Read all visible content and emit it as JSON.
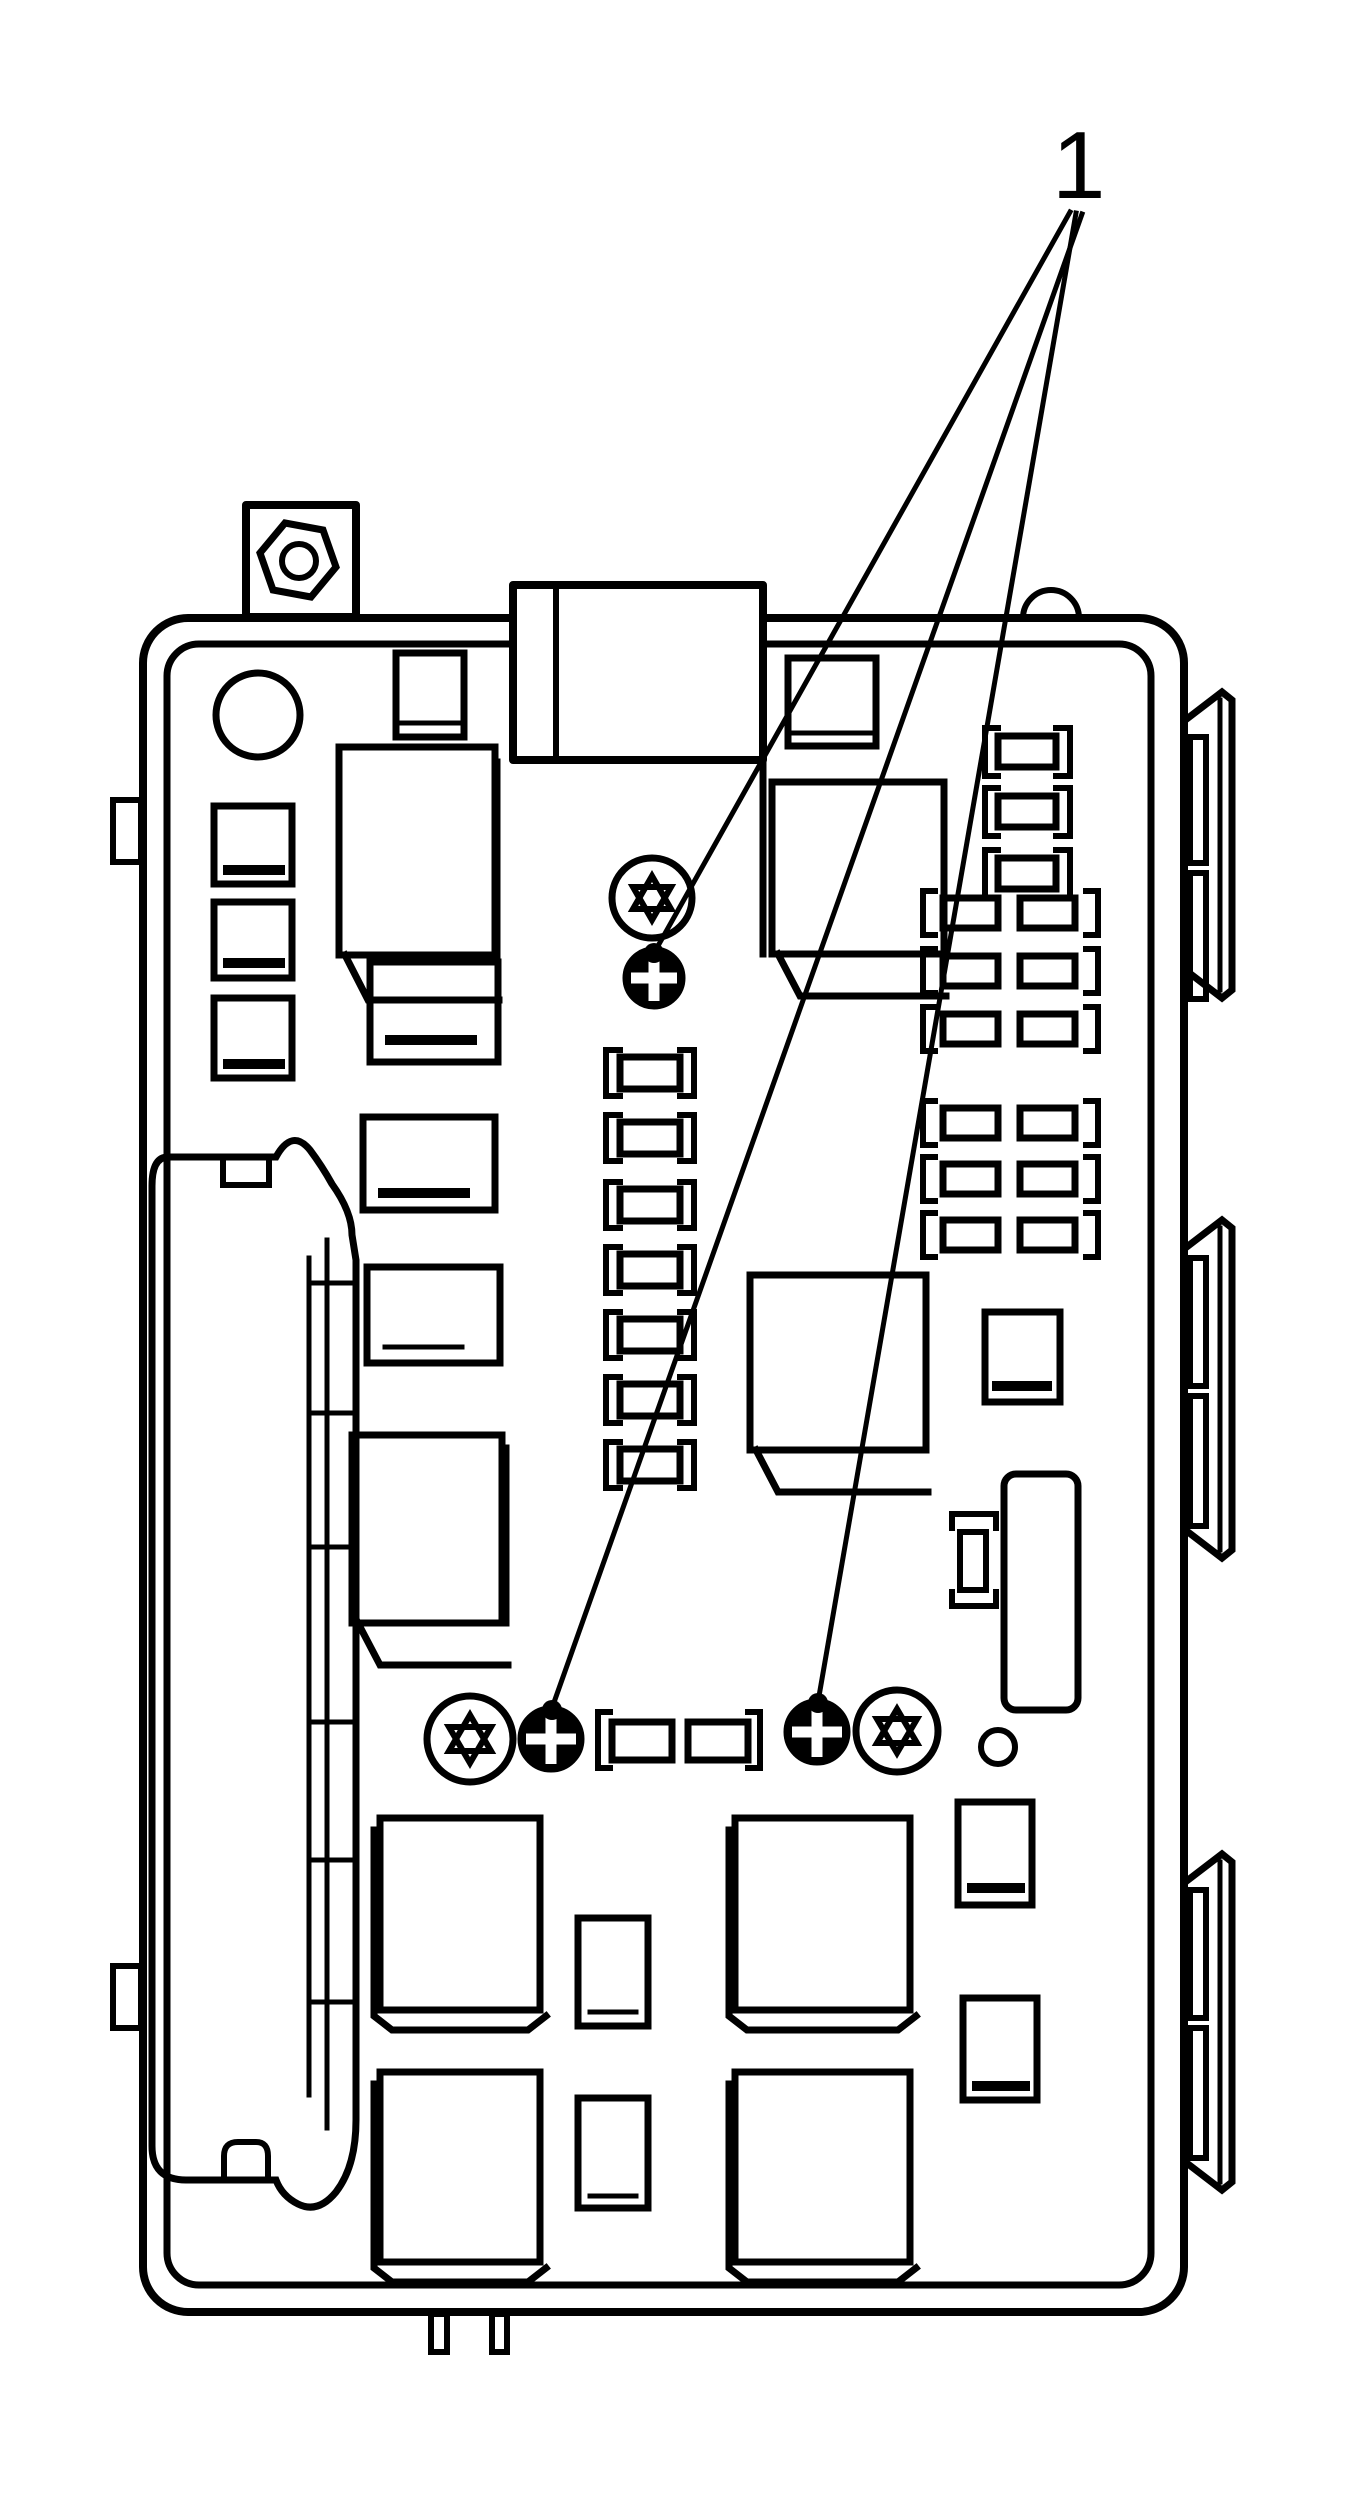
{
  "figure": {
    "kind": "technical-line-diagram",
    "subject": "electrical fuse-relay block with retaining screws"
  },
  "palette": {
    "ink": "#000000",
    "paper": "#ffffff"
  },
  "callout": {
    "label": "1",
    "leader_line_count": 3,
    "targets": [
      "top-phillips-screw",
      "left-phillips-screw",
      "right-phillips-screw"
    ]
  },
  "icons": {
    "torx_screw": "circle-with-six-point-star",
    "phillips_screw": "circle-with-cross",
    "hex_nut": "hexagon-with-circle",
    "fuse": "bracketed-rectangle",
    "relay": "square-with-shadow"
  }
}
